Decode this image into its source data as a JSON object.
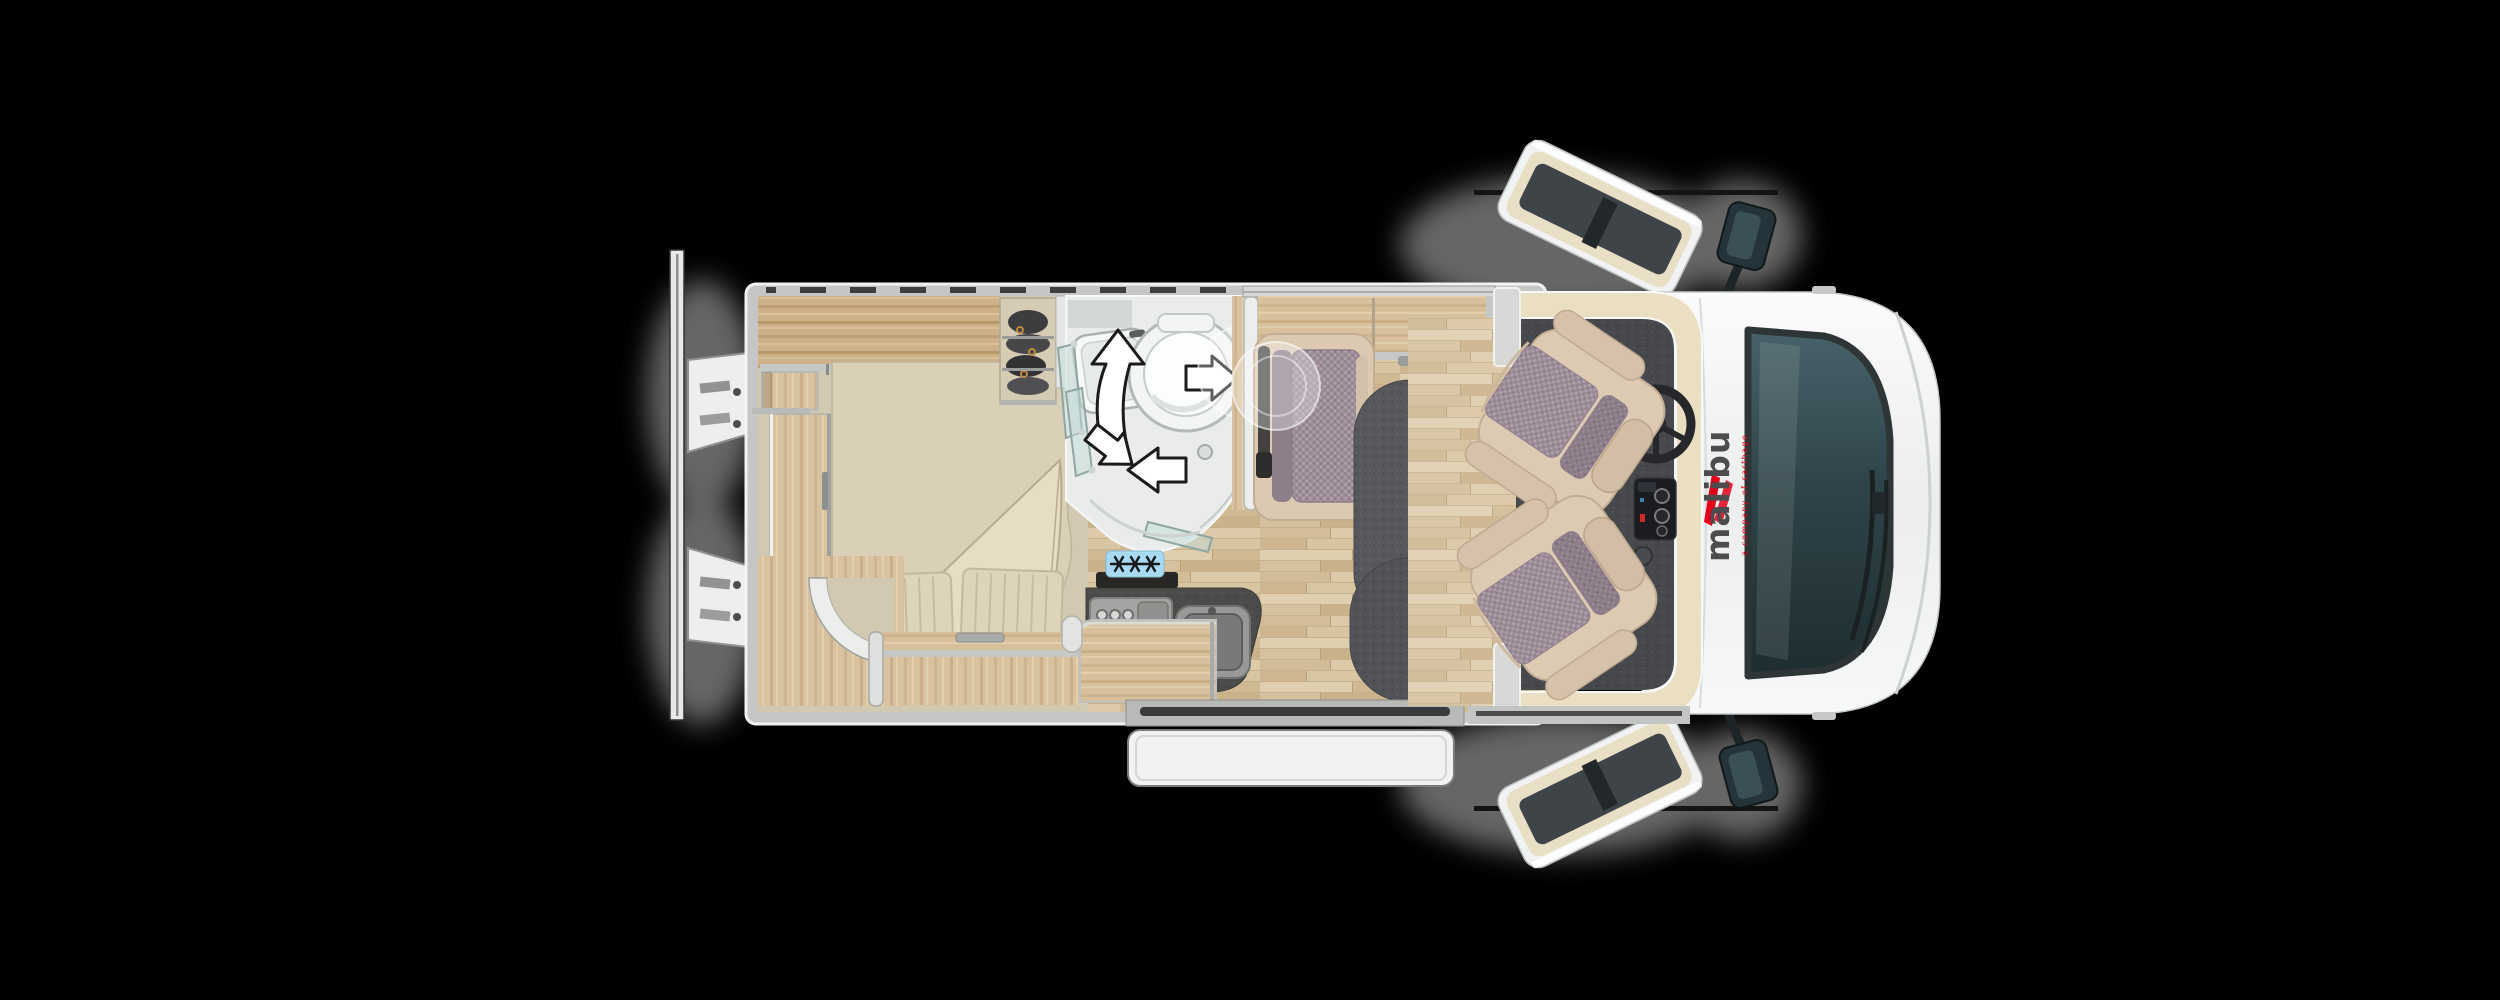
{
  "brand": {
    "logo_text": "malibu",
    "tagline": "a company of carthago",
    "logo_color": "#4c4c4e",
    "accent_red": "#e2001a"
  },
  "badge": {
    "freezer_text": "✳✳✳",
    "background": "#a8d9f2",
    "glyph_color": "#17191b"
  },
  "colors": {
    "background": "#000000",
    "body_white": "#f4f6f5",
    "wall_gray": "#c6c6c4",
    "wood": "#d8c09c",
    "floor_parquet": "#d9c6a3",
    "mattress_cream": "#d9d0b7",
    "counter_dark": "#4b4c49",
    "cab_floor": "#46484b",
    "cream_trim": "#ebdfc3",
    "seat_beige": "#ddcab3",
    "seat_fabric_mauve": "#9d8d99",
    "table_gray": "#57585c",
    "windshield_teal": "#2f4449",
    "bathroom_white": "#e9eceb"
  }
}
